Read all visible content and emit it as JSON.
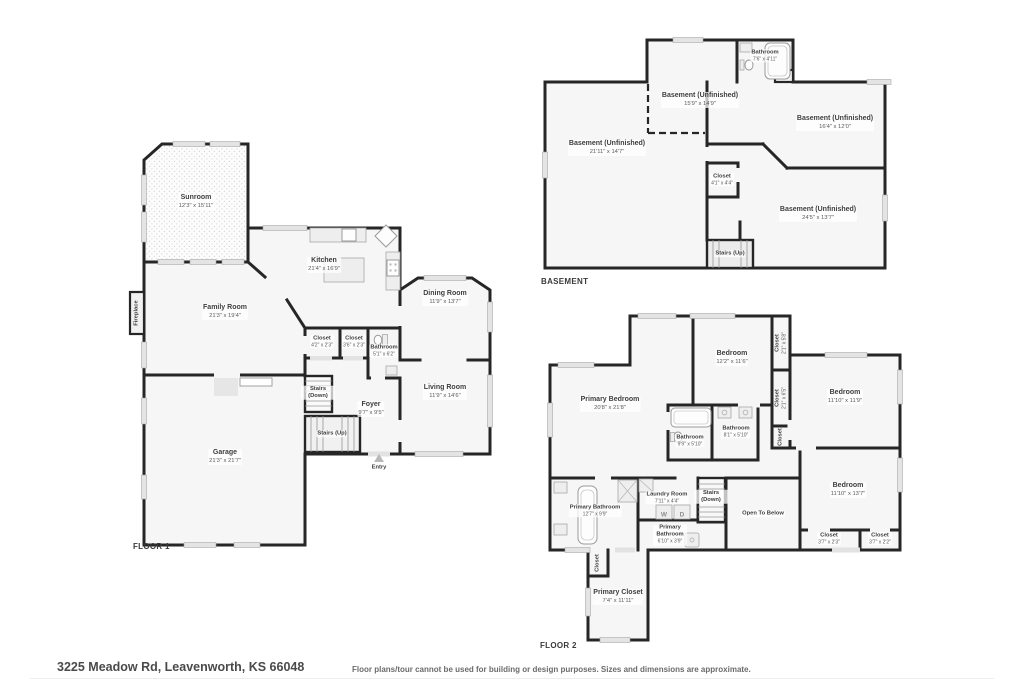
{
  "colors": {
    "wall": "#262626",
    "room_fill": "#f6f6f6",
    "window": "#e4e4e4"
  },
  "footer": {
    "address": "3225 Meadow Rd, Leavenworth, KS 66048",
    "disclaimer": "Floor plans/tour cannot be used for building or design purposes. Sizes and dimensions are approximate."
  },
  "floor1": {
    "title": "FLOOR 1",
    "rooms": {
      "sunroom": {
        "name": "Sunroom",
        "dims": "12'3\" x 15'11\""
      },
      "kitchen": {
        "name": "Kitchen",
        "dims": "21'4\" x 16'9\""
      },
      "dining": {
        "name": "Dining Room",
        "dims": "11'9\" x 13'7\""
      },
      "family": {
        "name": "Family Room",
        "dims": "21'3\" x 19'4\""
      },
      "closet1": {
        "name": "Closet",
        "dims": "4'2\" x 2'3\""
      },
      "closet2": {
        "name": "Closet",
        "dims": "3'6\" x 2'3\""
      },
      "bathroom": {
        "name": "Bathroom",
        "dims": "5'1\" x 6'2\""
      },
      "living": {
        "name": "Living Room",
        "dims": "11'9\" x 14'6\""
      },
      "stairs_down": {
        "name": "Stairs (Down)"
      },
      "foyer": {
        "name": "Foyer",
        "dims": "9'7\" x 9'5\""
      },
      "stairs_up": {
        "name": "Stairs (Up)"
      },
      "garage": {
        "name": "Garage",
        "dims": "21'3\" x 21'7\""
      },
      "entry": {
        "name": "Entry"
      },
      "fireplace": {
        "name": "Fireplace"
      }
    }
  },
  "basement": {
    "title": "BASEMENT",
    "rooms": {
      "bathroom": {
        "name": "Bathroom",
        "dims": "7'6\" x 4'11\""
      },
      "unf1": {
        "name": "Basement (Unfinished)",
        "dims": "15'9\" x 14'9\""
      },
      "unf2": {
        "name": "Basement (Unfinished)",
        "dims": "16'4\" x 12'0\""
      },
      "unf3": {
        "name": "Basement (Unfinished)",
        "dims": "21'11\" x 14'7\""
      },
      "unf4": {
        "name": "Basement (Unfinished)",
        "dims": "24'5\" x 13'7\""
      },
      "closet": {
        "name": "Closet",
        "dims": "4'1\" x 4'4\""
      },
      "stairs_up": {
        "name": "Stairs (Up)"
      }
    }
  },
  "floor2": {
    "title": "FLOOR 2",
    "rooms": {
      "primary_bedroom": {
        "name": "Primary Bedroom",
        "dims": "20'8\" x 21'8\""
      },
      "bedroom_top": {
        "name": "Bedroom",
        "dims": "12'2\" x 11'6\""
      },
      "bedroom_right": {
        "name": "Bedroom",
        "dims": "11'10\" x 11'9\""
      },
      "bedroom_bottom": {
        "name": "Bedroom",
        "dims": "11'10\" x 13'7\""
      },
      "closet_a": {
        "name": "Closet",
        "dims": "2'1\" x 5'8\""
      },
      "closet_b": {
        "name": "Closet",
        "dims": "2'1\" x 6'5\""
      },
      "closet_c": {
        "name": "Closet"
      },
      "bathroom1": {
        "name": "Bathroom",
        "dims": "9'9\" x 5'10\""
      },
      "bathroom2": {
        "name": "Bathroom",
        "dims": "8'1\" x 5'10\""
      },
      "primary_bathroom": {
        "name": "Primary Bathroom",
        "dims": "12'7\" x 9'9\""
      },
      "primary_bathroom2": {
        "name": "Primary Bathroom",
        "dims": "6'10\" x 3'9\""
      },
      "laundry": {
        "name": "Laundry Room",
        "dims": "7'11\" x 4'4\"",
        "washer": "W",
        "dryer": "D"
      },
      "stairs_down": {
        "name": "Stairs (Down)"
      },
      "open_below": {
        "name": "Open To Below"
      },
      "closet_d": {
        "name": "Closet",
        "dims": "3'7\" x 2'3\""
      },
      "closet_e": {
        "name": "Closet",
        "dims": "3'7\" x 2'2\""
      },
      "closet_f": {
        "name": "Closet"
      },
      "primary_closet": {
        "name": "Primary Closet",
        "dims": "7'4\" x 11'11\""
      }
    }
  }
}
